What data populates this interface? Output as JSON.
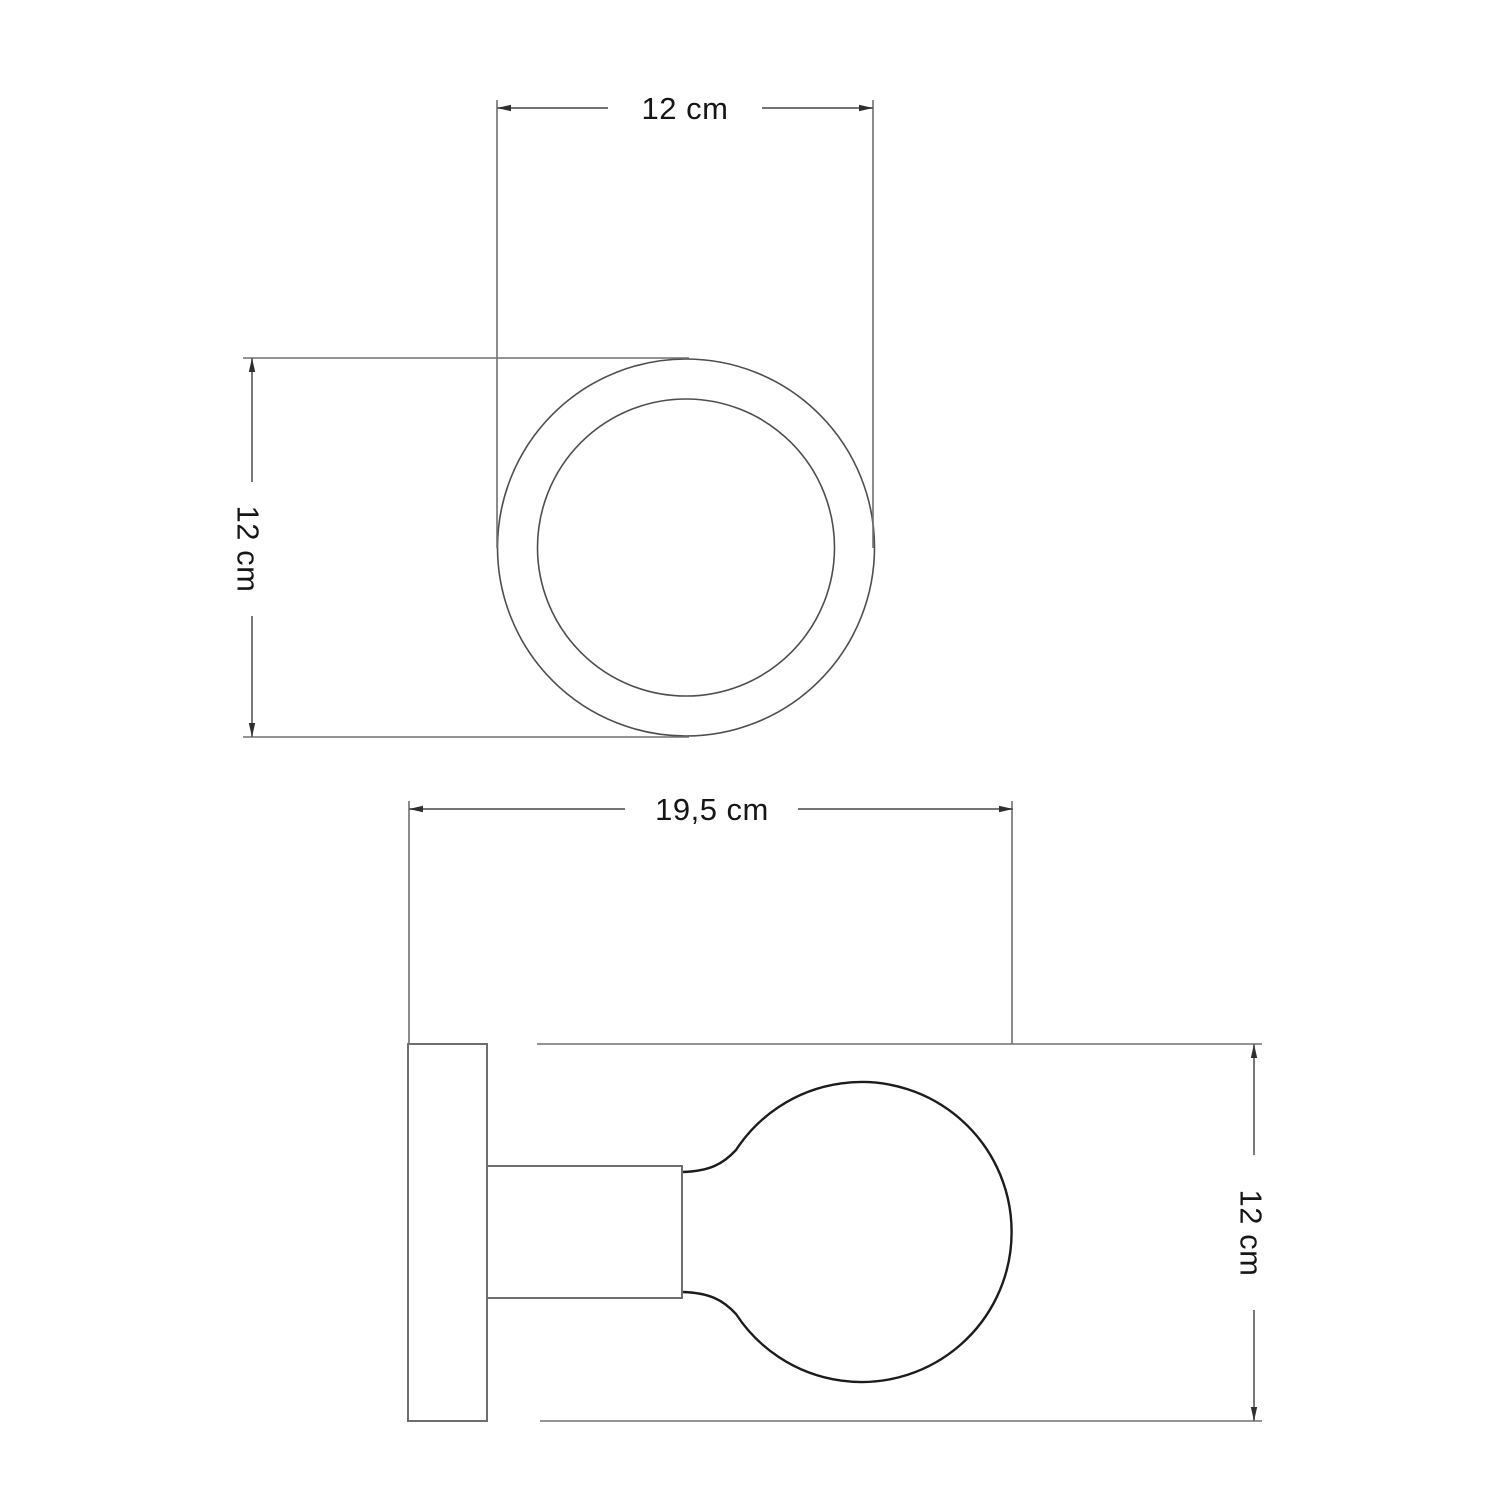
{
  "diagram": {
    "type": "product-dimension-drawing",
    "product": "wall lamp with round base and globe bulb",
    "views": {
      "top": {
        "width_label": "12 cm",
        "height_label": "12 cm"
      },
      "side": {
        "width_label": "19,5 cm",
        "height_label": "12 cm"
      }
    },
    "colors": {
      "background": "#ffffff",
      "extension_line": "#707070",
      "dimension_line": "#606060",
      "shape_outline": "#4e4e4e",
      "bulb_outline": "#1c1c1c",
      "text": "#161616"
    }
  }
}
